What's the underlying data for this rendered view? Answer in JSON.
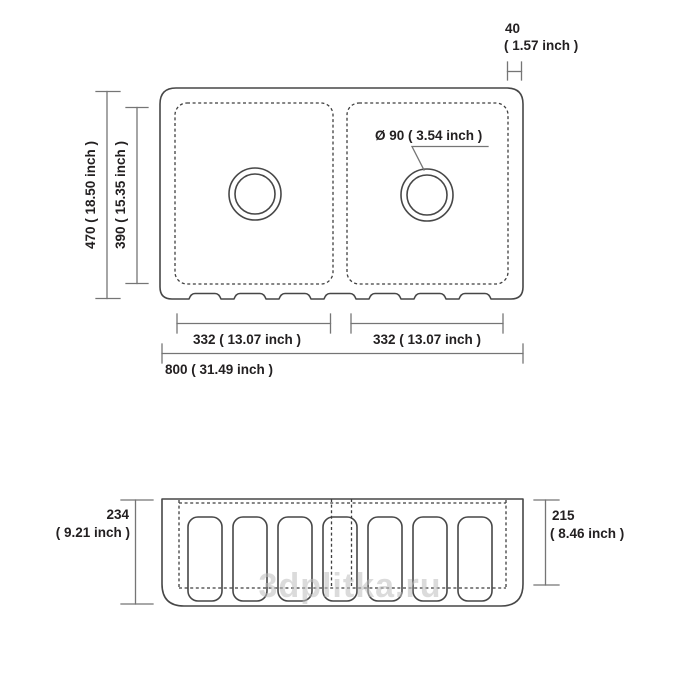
{
  "watermark": {
    "text": "3dplitka.ru"
  },
  "colors": {
    "outline": "#474747",
    "hidden": "#3f3f3f",
    "dim": "#757575",
    "text": "#232021",
    "watermark": "#bfbfbf"
  },
  "top_view": {
    "drain_label": "Ø 90 ( 3.54 inch )",
    "rim_gap": {
      "mm": "40",
      "inch": "( 1.57 inch )"
    },
    "outer_height_label": "470 ( 18.50 inch )",
    "bowl_height_label": "390 ( 15.35 inch )",
    "bowl_left_width_label": "332 ( 13.07 inch )",
    "bowl_right_width_label": "332 ( 13.07 inch )",
    "total_width_label": "800 ( 31.49 inch )"
  },
  "front_view": {
    "total_height": {
      "mm": "234",
      "inch": "( 9.21 inch )"
    },
    "bowl_depth": {
      "mm": "215",
      "inch": "( 8.46 inch )"
    }
  }
}
